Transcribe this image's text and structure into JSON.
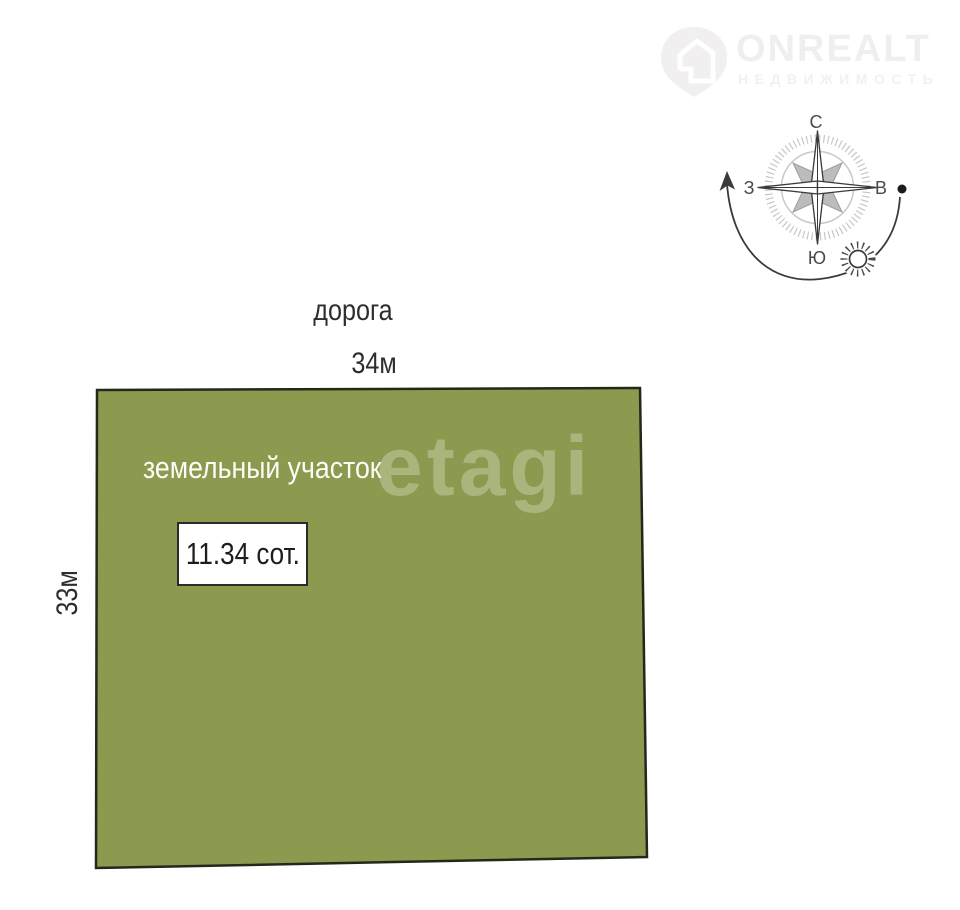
{
  "logo": {
    "brand": "ONREALT",
    "subtitle": "НЕДВИЖИМОСТЬ",
    "color": "#f0eff0"
  },
  "compass": {
    "north_label": "С",
    "south_label": "Ю",
    "west_label": "З",
    "east_label": "В"
  },
  "road_label": "дорога",
  "plot": {
    "title": "земельный участок",
    "area_label": "11.34 сот.",
    "top_dimension": "34м",
    "left_dimension": "33м",
    "fill_color": "#8b9a4f",
    "border_color": "#23281b"
  },
  "watermark_label": "etagi"
}
